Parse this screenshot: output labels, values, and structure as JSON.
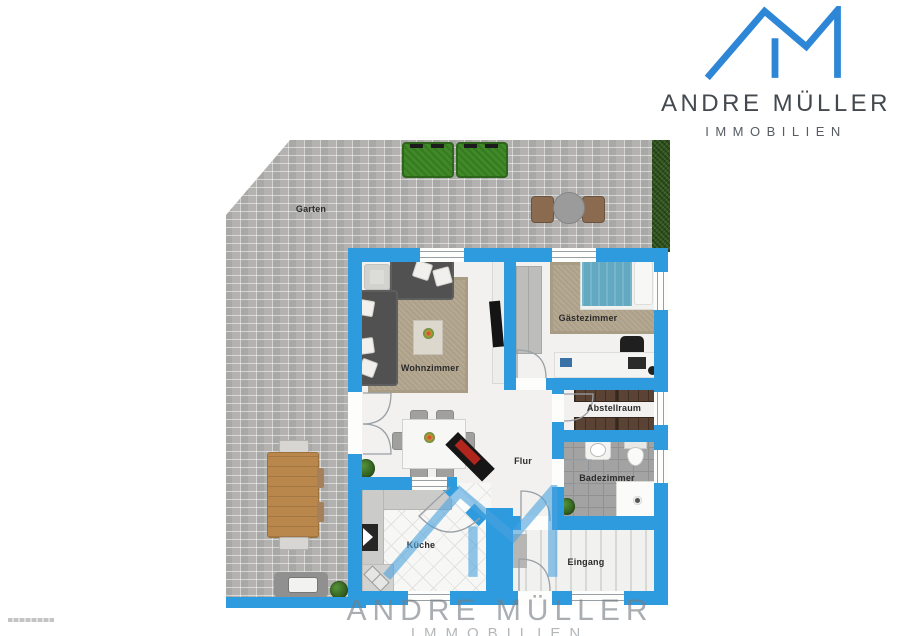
{
  "brand": {
    "name": "ANDRE MÜLLER",
    "division": "IMMOBILIEN"
  },
  "watermark": {
    "name": "ANDRE MÜLLER",
    "division": "IMMOBILIEN"
  },
  "floorplan": {
    "rooms": {
      "garten": {
        "label": "Garten"
      },
      "wohnzimmer": {
        "label": "Wohnzimmer"
      },
      "gaestezimmer": {
        "label": "Gästezimmer"
      },
      "abstellraum": {
        "label": "Abstellraum"
      },
      "flur": {
        "label": "Flur"
      },
      "badezimmer": {
        "label": "Badezimmer"
      },
      "kueche": {
        "label": "Küche"
      },
      "eingang": {
        "label": "Eingang"
      }
    }
  },
  "colors": {
    "wall": "#2D9BDE",
    "logo_blue": "#2E86D6",
    "watermark_blue": "#4BA3DF",
    "brand_text": "#43494E",
    "paving": "#B3B2B0",
    "hedge": "#33591F",
    "bush": "#3F8A27",
    "bath_tile": "#A3A3A3",
    "rug": "#B6A992",
    "shelf": "#5A4335",
    "bed": "#62A9C1",
    "label_text": "#2B2B2B"
  }
}
